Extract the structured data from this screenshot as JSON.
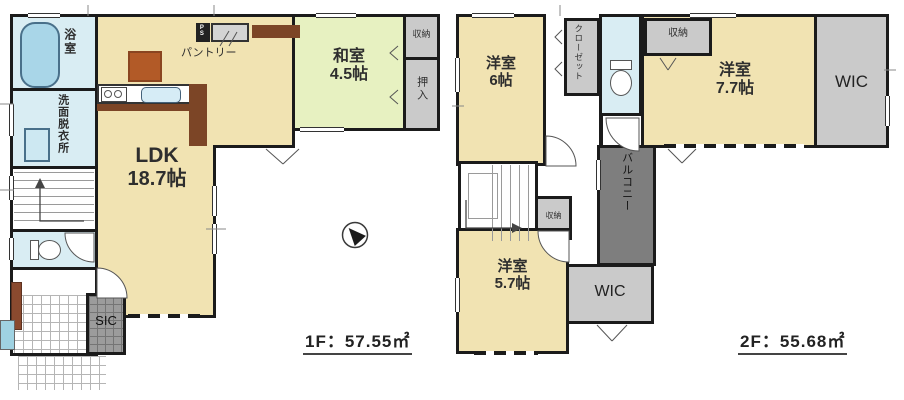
{
  "colors": {
    "wall": "#1b1b1b",
    "room_cream": "#f1e3b2",
    "room_tatami": "#e7f1c1",
    "room_wet": "#d9edf3",
    "storage_gray": "#cacaca",
    "balcony_gray": "#7e7e7e",
    "sic_gray": "#9c9c9c",
    "counter_brown": "#7c4526",
    "cabinet_brown": "#b25a27",
    "bathtub_blue": "#a9d6e8"
  },
  "icons": {
    "compass": "north-arrow-icon"
  },
  "floor1": {
    "area_label": "1F：57.55㎡",
    "ldk": {
      "name": "LDK",
      "size": "18.7帖"
    },
    "washitsu": {
      "name": "和室",
      "size": "4.5帖"
    },
    "bath": "浴室",
    "washroom": "洗面脱衣所",
    "pantry": "パントリー",
    "ps": "PS",
    "storage": "収納",
    "oshiire": "押入",
    "sic": "SIC"
  },
  "floor2": {
    "area_label": "2F：55.68㎡",
    "room6": {
      "name": "洋室",
      "size": "6帖"
    },
    "room77": {
      "name": "洋室",
      "size": "7.7帖"
    },
    "room57": {
      "name": "洋室",
      "size": "5.7帖"
    },
    "closet": "クローゼット",
    "storage_top": "収納",
    "storage_stairs": "収納",
    "wic_top": "WIC",
    "wic_bottom": "WIC",
    "balcony": "バルコニー"
  }
}
